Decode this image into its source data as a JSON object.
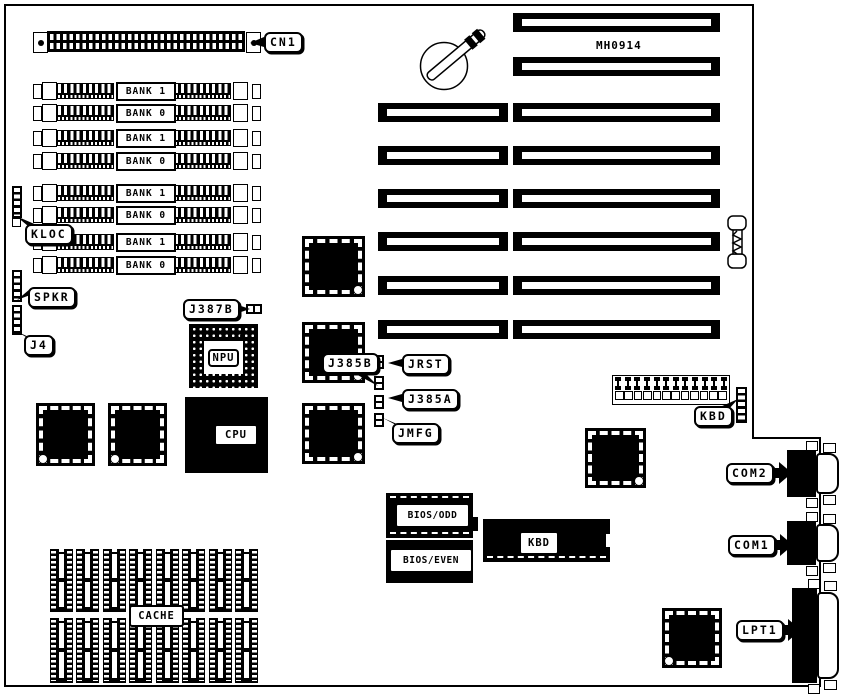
{
  "board": {
    "id_label": "MH0914"
  },
  "memory": {
    "slots": [
      "BANK 1",
      "BANK 0",
      "BANK 1",
      "BANK 0",
      "BANK 1",
      "BANK 0",
      "BANK 1",
      "BANK 0"
    ]
  },
  "callouts": {
    "cn1": "CN1",
    "kloc": "KLOC",
    "spkr": "SPKR",
    "j4": "J4",
    "j387b": "J387B",
    "j385b": "J385B",
    "jrst": "JRST",
    "j385a": "J385A",
    "jmfg": "JMFG",
    "kbd": "KBD",
    "com2": "COM2",
    "com1": "COM1",
    "lpt1": "LPT1"
  },
  "chips": {
    "npu": "NPU",
    "cpu": "CPU",
    "bios_odd": "BIOS/ODD",
    "bios_even": "BIOS/EVEN",
    "kbd_controller": "KBD",
    "cache": "CACHE"
  },
  "expansion": {
    "left_slot_count": 6,
    "right_slot_count": 8
  },
  "cache_sockets": {
    "rows": 2,
    "per_row": 8
  },
  "colors": {
    "ink": "#000000",
    "background": "#ffffff"
  }
}
